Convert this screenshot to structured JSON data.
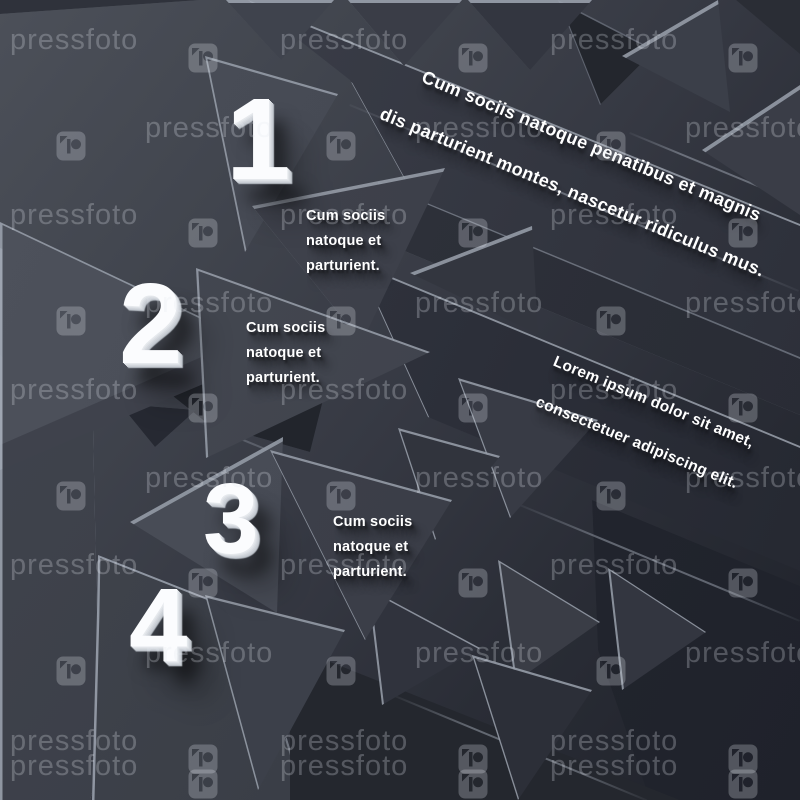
{
  "canvas": {
    "description": "Dark abstract 3D paper triangles infographic, watermarked stock preview"
  },
  "steps": [
    {
      "number": "1",
      "caption_lines": [
        "Cum sociis",
        "natoque et",
        "parturient."
      ]
    },
    {
      "number": "2",
      "caption_lines": [
        "Cum sociis",
        "natoque et",
        "parturient."
      ]
    },
    {
      "number": "3",
      "caption_lines": [
        "Cum sociis",
        "natoque et",
        "parturient."
      ]
    },
    {
      "number": "4",
      "caption_lines": []
    }
  ],
  "banners": {
    "top": {
      "lines": [
        "Cum sociis natoque penatibus et magnis",
        "dis parturient montes, nascetur ridiculus mus."
      ]
    },
    "right": {
      "lines": [
        "Lorem ipsum dolor sit amet,",
        "consectetuer adipiscing elit."
      ]
    }
  },
  "watermark": {
    "brand": "pressfoto",
    "logo_icon": "pressfoto-p-camera-logo"
  },
  "colors": {
    "background_light": "#4c5059",
    "background_dark": "#1e2129",
    "perforated_base": "#1b1d23",
    "hole": "#04060a",
    "number_face": "#fbfcfe",
    "number_side": "#c8cdd4",
    "text": "#ffffff",
    "watermark": "rgba(228,233,241,0.26)"
  }
}
